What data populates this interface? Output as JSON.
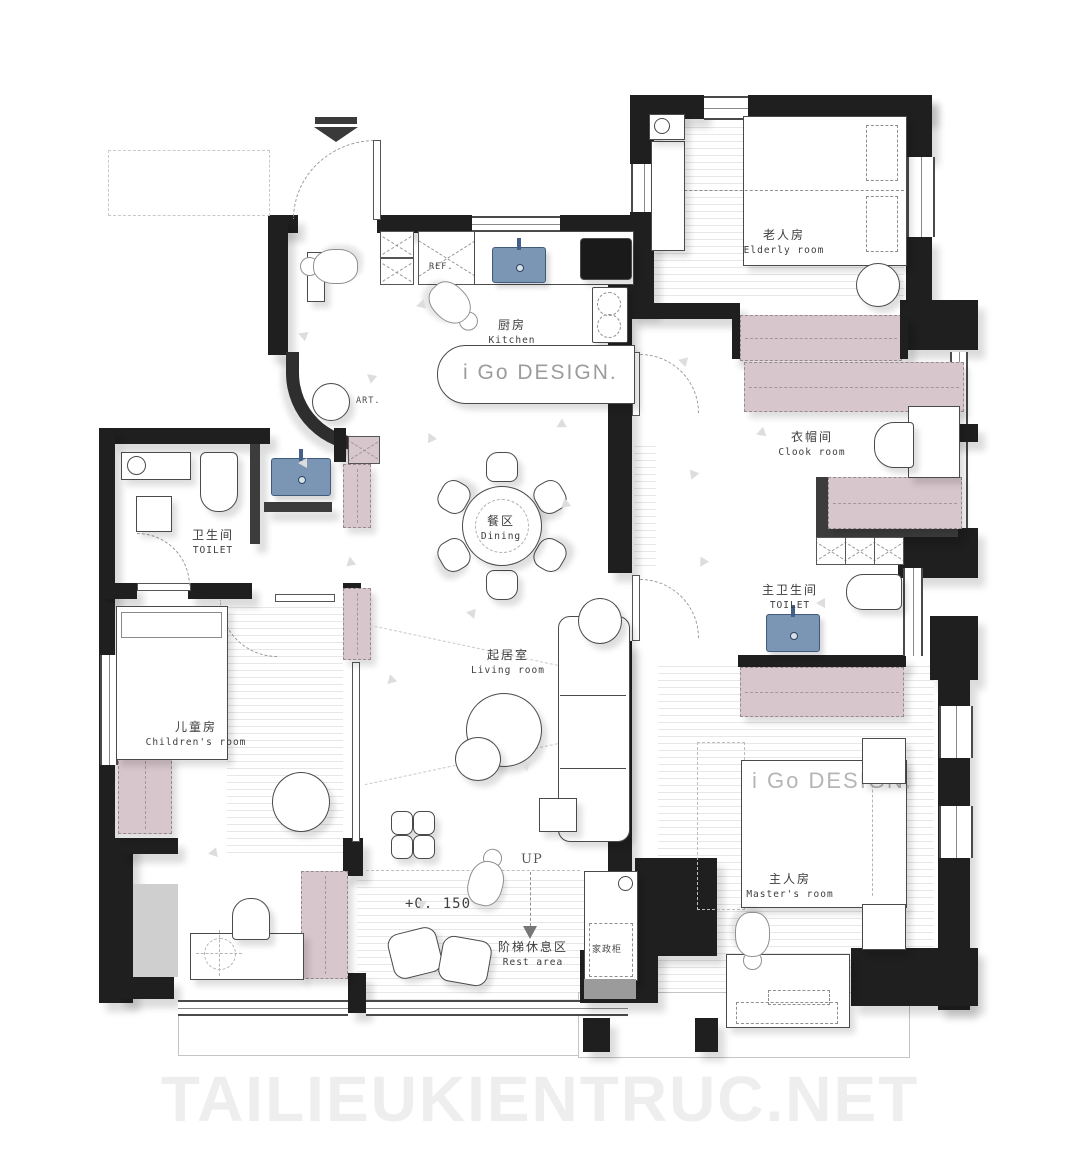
{
  "watermark": "TAILIEUKIENTRUC.NET",
  "brand": {
    "kitchen_island_label": "i Go DESIGN.",
    "master_bed_label": "i Go DESIGN."
  },
  "rooms": {
    "kitchen": {
      "zh": "厨房",
      "en": "Kitchen"
    },
    "elderly": {
      "zh": "老人房",
      "en": "Elderly room"
    },
    "cloak": {
      "zh": "衣帽间",
      "en": "Clook room"
    },
    "master_toilet": {
      "zh": "主卫生间",
      "en": "TOILET"
    },
    "dining": {
      "zh": "餐区",
      "en": "Dining"
    },
    "living": {
      "zh": "起居室",
      "en": "Living room"
    },
    "toilet": {
      "zh": "卫生间",
      "en": "TOILET"
    },
    "children": {
      "zh": "儿童房",
      "en": "Children's room"
    },
    "master": {
      "zh": "主人房",
      "en": "Master's room"
    },
    "rest": {
      "zh": "阶梯休息区",
      "en": "Rest area"
    }
  },
  "annotations": {
    "ref": "REF.",
    "art": "ART.",
    "up": "UP",
    "floor_level": "+0. 150",
    "housekeeping_cabinet": "家政柜"
  },
  "colors": {
    "wall": "#1f1f1f",
    "graywall": "#3c3c3c",
    "pink": "#d7c6cb",
    "blue": "#7b95b4",
    "watermark": "#eeeeee"
  }
}
